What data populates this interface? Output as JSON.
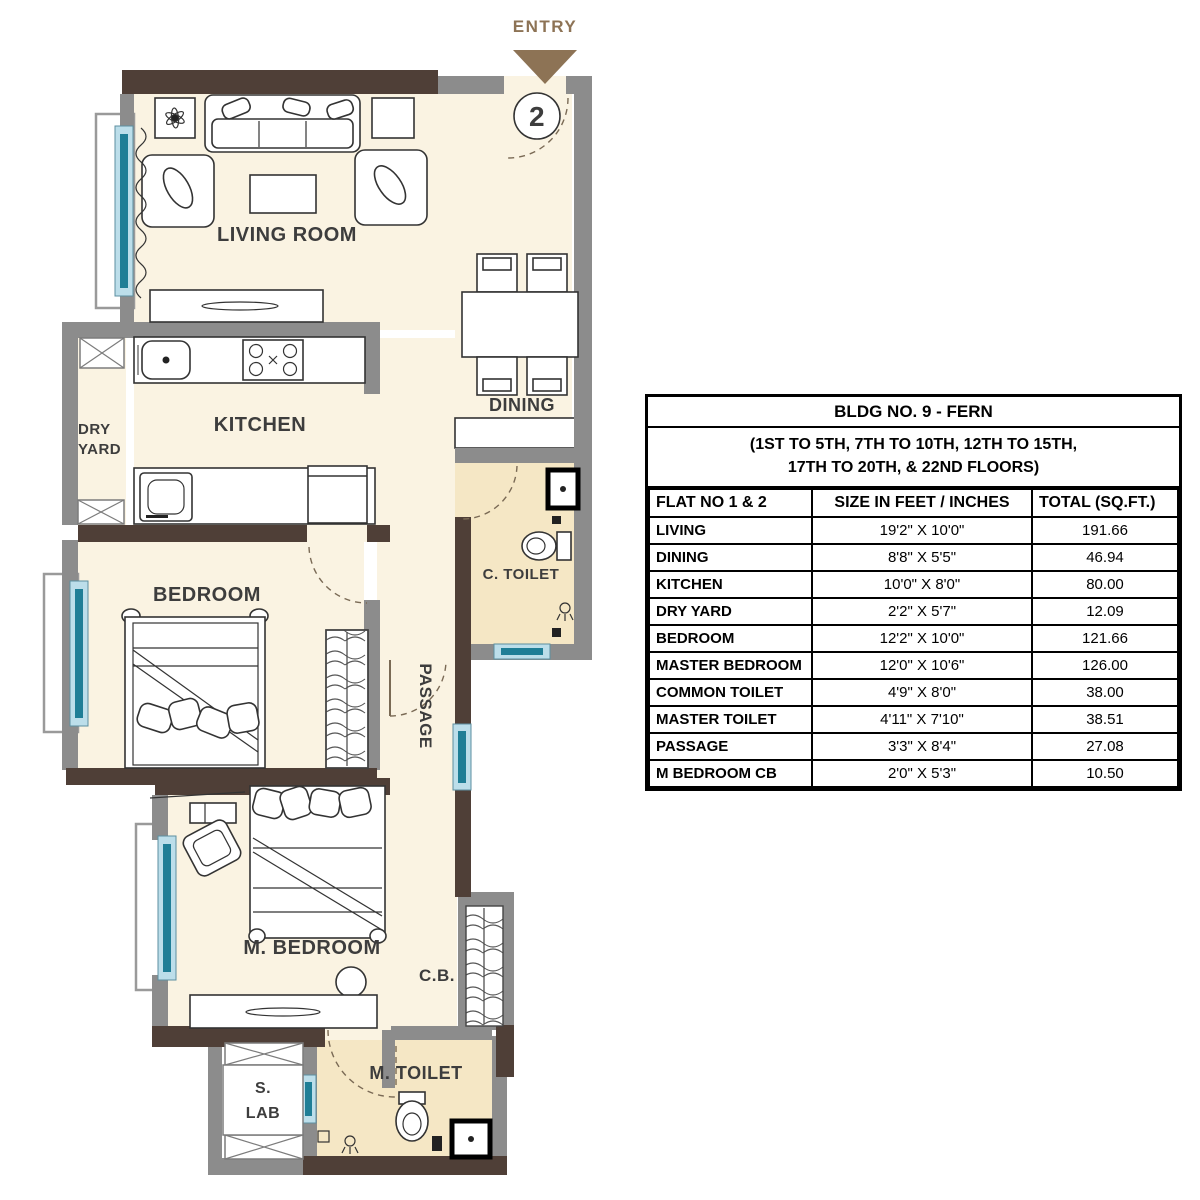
{
  "plan": {
    "entry_label": "ENTRY",
    "unit_number": "2",
    "rooms": {
      "living_room": "LIVING ROOM",
      "dining": "DINING",
      "kitchen": "KITCHEN",
      "dry_yard_line1": "DRY",
      "dry_yard_line2": "YARD",
      "bedroom": "BEDROOM",
      "passage": "PASSAGE",
      "common_toilet": "C. TOILET",
      "master_bedroom": "M. BEDROOM",
      "cupboard": "C.B.",
      "master_toilet": "M. TOILET",
      "service_lab_line1": "S.",
      "service_lab_line2": "LAB"
    },
    "colors": {
      "wall_gray": "#8c8c8c",
      "wall_dark_brown": "#4f3f37",
      "floor_cream": "#faf3e2",
      "toilet_beige": "#f5e7c5",
      "window_teal": "#1f7e96",
      "window_frame": "#bcdeea",
      "entry_brown": "#8d7355",
      "label_color": "#3d3d3d"
    }
  },
  "table": {
    "title": "BLDG NO. 9 - FERN",
    "subtitle_line1": "(1ST TO 5TH, 7TH TO 10TH, 12TH TO 15TH,",
    "subtitle_line2": "17TH TO 20TH, & 22ND FLOORS)",
    "columns": [
      "FLAT NO 1 & 2",
      "SIZE IN FEET / INCHES",
      "TOTAL (SQ.FT.)"
    ],
    "rows": [
      {
        "room": "LIVING",
        "size": "19'2\" X 10'0\"",
        "total": "191.66"
      },
      {
        "room": "DINING",
        "size": "8'8\" X 5'5\"",
        "total": "46.94"
      },
      {
        "room": "KITCHEN",
        "size": "10'0\" X 8'0\"",
        "total": "80.00"
      },
      {
        "room": "DRY YARD",
        "size": "2'2\" X 5'7\"",
        "total": "12.09"
      },
      {
        "room": "BEDROOM",
        "size": "12'2\" X 10'0\"",
        "total": "121.66"
      },
      {
        "room": "MASTER BEDROOM",
        "size": "12'0\" X 10'6\"",
        "total": "126.00"
      },
      {
        "room": "COMMON TOILET",
        "size": "4'9\" X 8'0\"",
        "total": "38.00"
      },
      {
        "room": "MASTER TOILET",
        "size": "4'11\" X 7'10\"",
        "total": "38.51"
      },
      {
        "room": "PASSAGE",
        "size": "3'3\" X 8'4\"",
        "total": "27.08"
      },
      {
        "room": "M BEDROOM CB",
        "size": "2'0\" X 5'3\"",
        "total": "10.50"
      }
    ]
  }
}
